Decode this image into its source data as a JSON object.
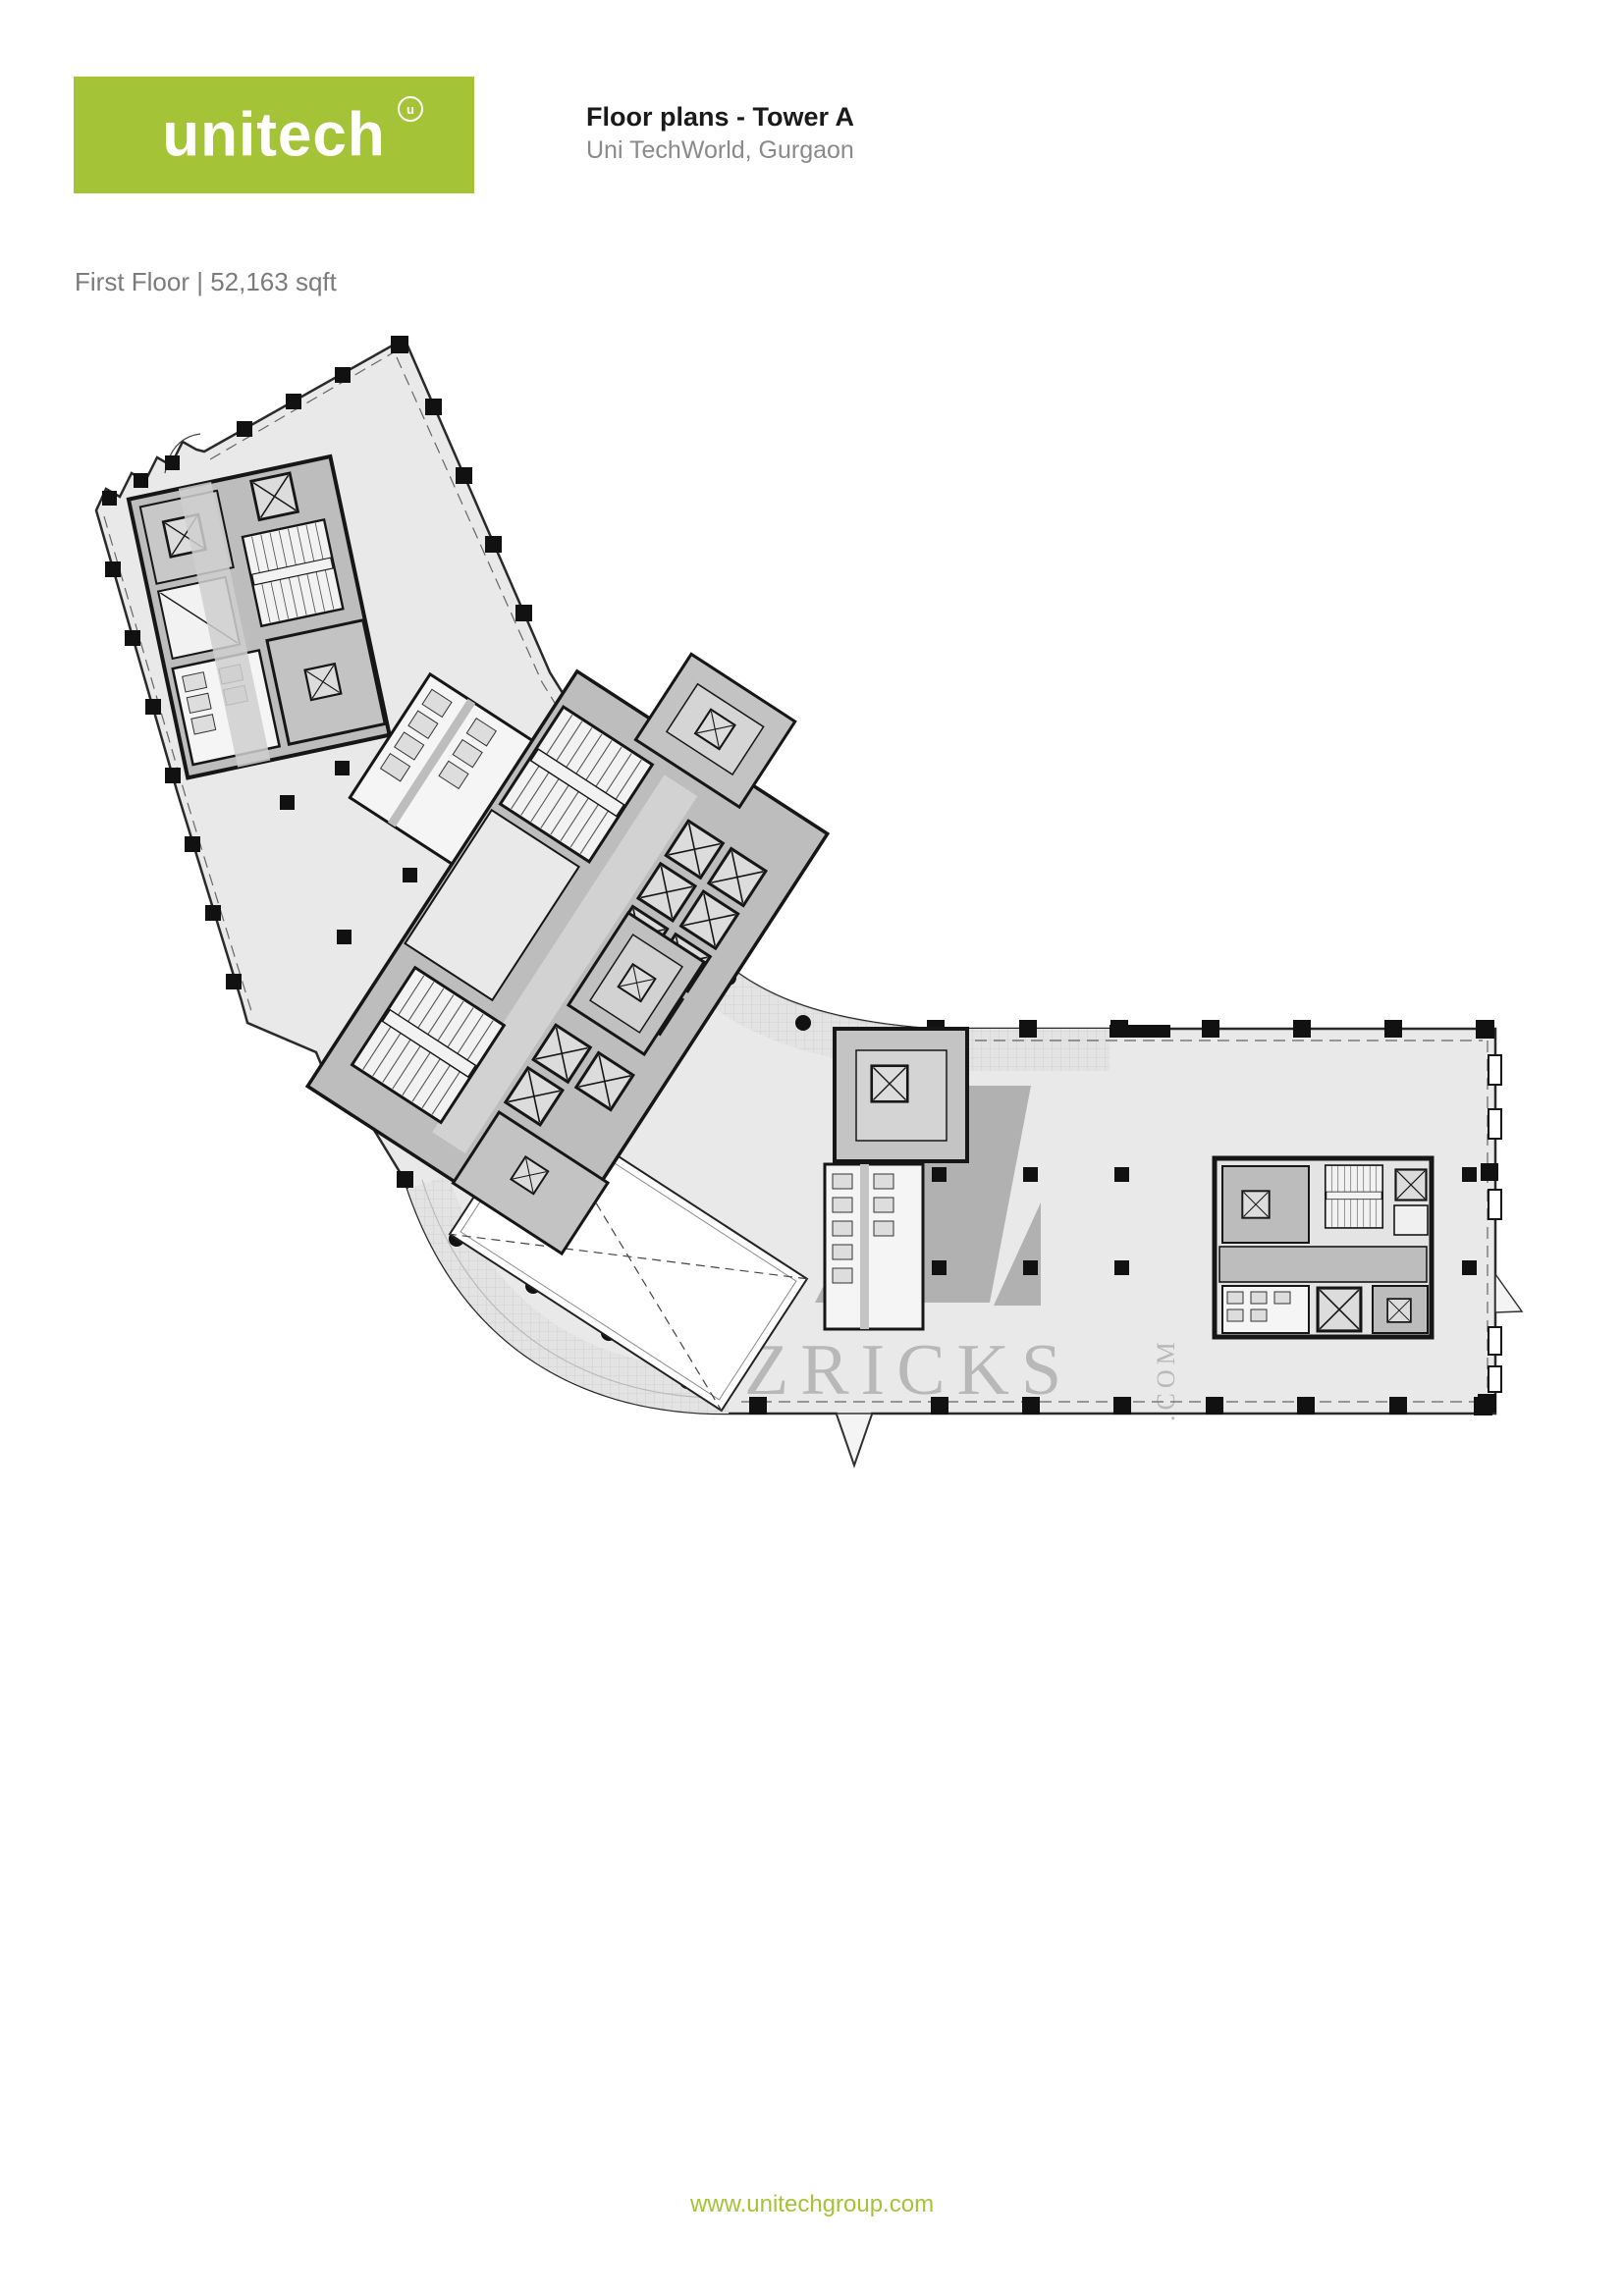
{
  "header": {
    "logo_text": "unitech",
    "logo_mark": "u",
    "title": "Floor plans - Tower A",
    "subtitle": "Uni TechWorld, Gurgaon"
  },
  "plan": {
    "label": "First Floor | 52,163 sqft",
    "watermark": "ZRICKS",
    "watermark_suffix": ".COM"
  },
  "footer": {
    "url": "www.unitechgroup.com"
  },
  "colors": {
    "brand_green": "#a5c337",
    "watermark_gray": "#b3b3b3",
    "floor_fill": "#e9e9e9",
    "core_fill": "#bdbdbd",
    "wall_black": "#1a1a1a"
  }
}
